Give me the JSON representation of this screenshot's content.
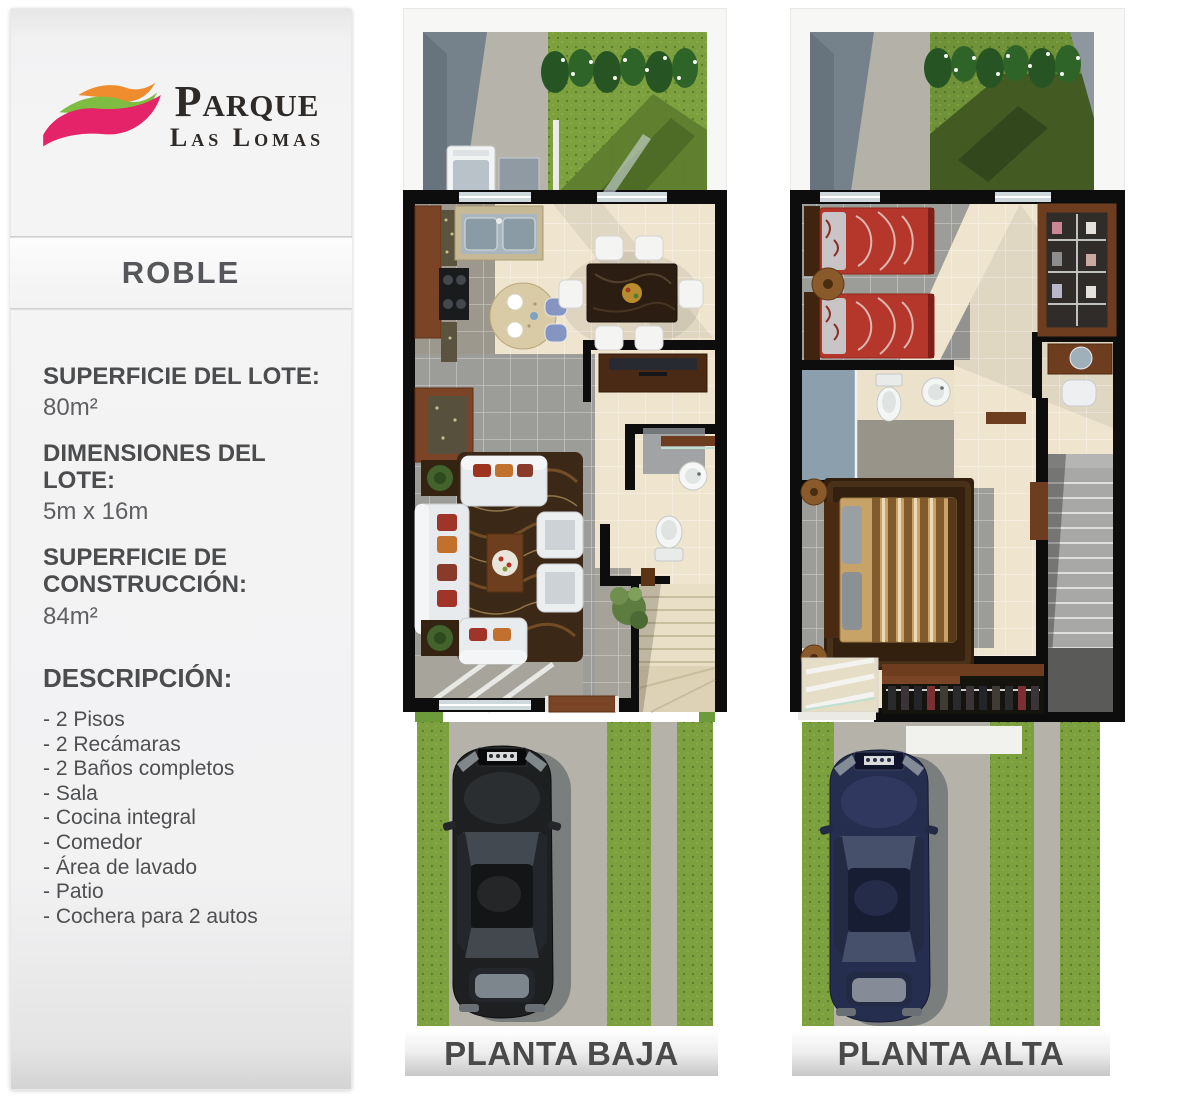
{
  "sidebar": {
    "brand": {
      "name_line1": "Parque",
      "name_line2": "Las Lomas",
      "swoosh_colors": {
        "top": "#ef8c2d",
        "middle": "#7fbc42",
        "bottom": "#e42369"
      }
    },
    "model_name": "ROBLE",
    "specs": [
      {
        "label": "SUPERFICIE DEL LOTE:",
        "value": "80m²"
      },
      {
        "label": "DIMENSIONES DEL LOTE:",
        "value": "5m x 16m"
      },
      {
        "label": "SUPERFICIE DE CONSTRUCCIÓN:",
        "value": "84m²"
      }
    ],
    "description": {
      "heading": "DESCRIPCIÓN:",
      "items": [
        "- 2 Pisos",
        "- 2 Recámaras",
        "- 2 Baños completos",
        "- Sala",
        "- Cocina integral",
        "- Comedor",
        "- Área de lavado",
        "- Patio",
        "- Cochera para 2 autos"
      ]
    }
  },
  "plans": [
    {
      "label": "PLANTA BAJA"
    },
    {
      "label": "PLANTA ALTA"
    }
  ],
  "colors": {
    "accent_pink": "#e42369",
    "accent_green": "#7fbc42",
    "accent_orange": "#ef8c2d",
    "grass": "#7ba03d",
    "grass_shade": "#5e7c2d",
    "grass_upper": "#6f9238",
    "concrete": "#b5b2a9",
    "wall": "#0d0d0d",
    "floor_beige": "#efe5cf",
    "floor_gray": "#9c9c99",
    "wood": "#7a4527",
    "bed_red": "#b5372b",
    "bed_tan": "#c7a368",
    "car_ground": "#1d1f21",
    "car_upper": "#262e4f",
    "label_text": "#4a4a4a"
  }
}
